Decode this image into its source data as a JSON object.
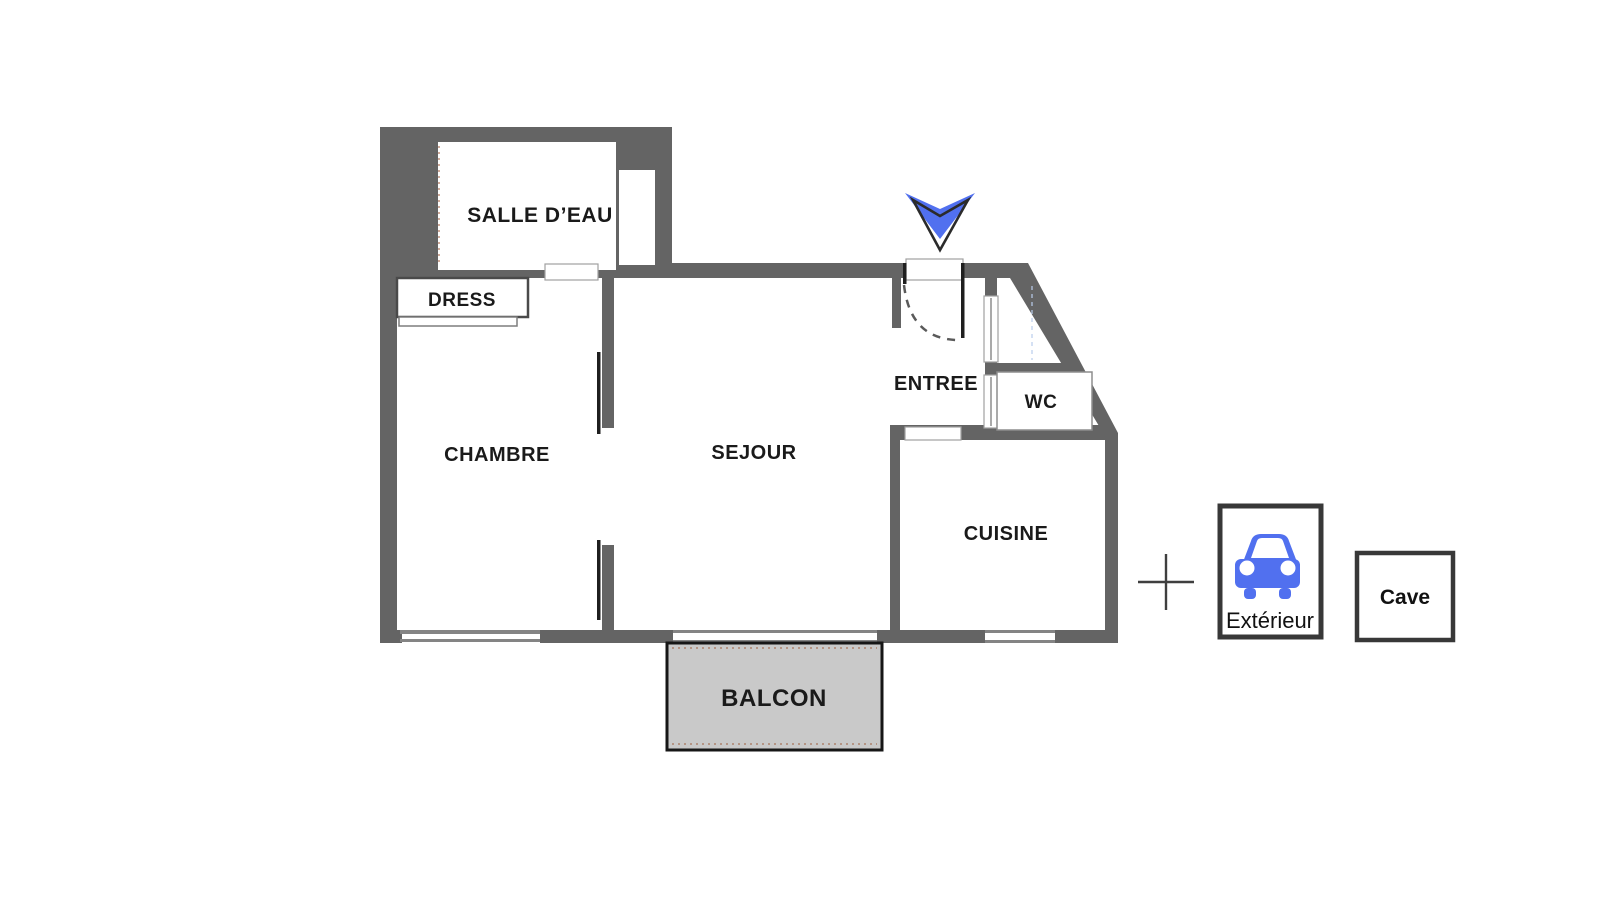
{
  "floorplan": {
    "rooms": {
      "salle_deau": "SALLE D’EAU",
      "dress": "DRESS",
      "chambre": "CHAMBRE",
      "sejour": "SEJOUR",
      "entree": "ENTREE",
      "wc": "WC",
      "cuisine": "CUISINE",
      "balcon": "BALCON"
    },
    "entrance_arrow_icon": "chevron-down-entrance-marker"
  },
  "annexes": {
    "separator_icon": "plus",
    "exterieur": {
      "label": "Extérieur",
      "icon": "car-front"
    },
    "cave": {
      "label": "Cave"
    }
  },
  "colors": {
    "wall": "#646464",
    "accent_blue": "#5170ef",
    "balcony_fill": "#c9c9c9",
    "label_text": "#1a1a1a",
    "box_border": "#383838",
    "dashed_accent": "#a9755b",
    "thin_line": "#848484",
    "black_line": "#1f1f1f"
  }
}
